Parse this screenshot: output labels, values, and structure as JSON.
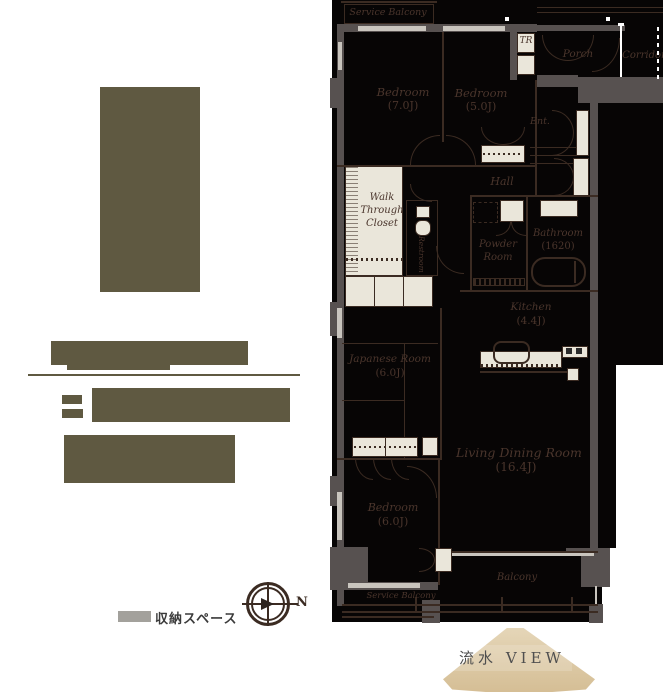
{
  "floorplan": {
    "service_balcony_top": "Service Balcony",
    "bedroom1_name": "Bedroom",
    "bedroom1_size": "(7.0J)",
    "bedroom2_name": "Bedroom",
    "bedroom2_size": "(5.0J)",
    "tr": "TR",
    "porch": "Porch",
    "corridor": "Corridor",
    "ent": "Ent.",
    "hall": "Hall",
    "wtc_line1": "Walk",
    "wtc_line2": "Through",
    "wtc_line3": "Closet",
    "restroom": "Restroom",
    "powder_line1": "Powder",
    "powder_line2": "Room",
    "bathroom_name": "Bathroom",
    "bathroom_size": "(1620)",
    "kitchen_name": "Kitchen",
    "kitchen_size": "(4.4J)",
    "japanese_name": "Japanese Room",
    "japanese_size": "(6.0J)",
    "living_name": "Living Dining Room",
    "living_size": "(16.4J)",
    "bedroom3_name": "Bedroom",
    "bedroom3_size": "(6.0J)",
    "balcony": "Balcony",
    "service_balcony_bottom": "Service Balcony"
  },
  "legend": {
    "storage": "収納スペース"
  },
  "compass": {
    "north": "N"
  },
  "view": {
    "label": "流水 VIEW"
  },
  "colors": {
    "accent_olive": "#5F5941",
    "plan_black": "#070505",
    "wall_gray": "#575150",
    "fixture_beige": "#EAE6DA",
    "line_brown": "#3B2B22",
    "fan_beige": "#DCC8A4"
  }
}
